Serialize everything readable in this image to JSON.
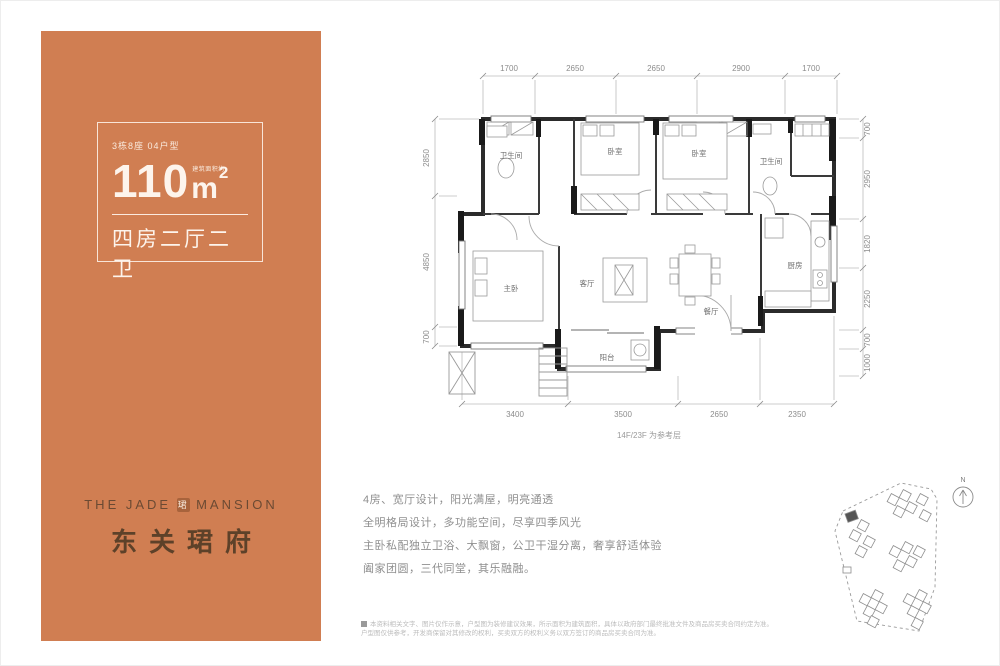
{
  "panel": {
    "unit_label": "3栋8座 04户型",
    "area_prefix": "建筑面积约",
    "area_value": "110",
    "area_unit": "m",
    "area_sup": "2",
    "layout_label": "四房二厅二卫",
    "brand_en_left": "THE JADE",
    "brand_logo_glyph": "珺",
    "brand_en_right": "MANSION",
    "brand_cn": "东关珺府",
    "bg_color": "#d07e52"
  },
  "floorplan": {
    "dims_top": [
      "1700",
      "2650",
      "2650",
      "2900",
      "1700"
    ],
    "dims_bottom": [
      "3400",
      "3500",
      "2650",
      "2350"
    ],
    "dims_left": [
      "2850",
      "4850",
      "700"
    ],
    "dims_right": [
      "700",
      "2950",
      "1820",
      "2250",
      "700",
      "1000"
    ],
    "note": "14F/23F 为参考层",
    "rooms": {
      "bath1": "卫生间",
      "bed1": "卧室",
      "bed2": "卧室",
      "bath2": "卫生间",
      "kitchen": "厨房",
      "living": "客厅",
      "dining": "餐厅",
      "master": "主卧",
      "balcony": "阳台"
    }
  },
  "description": {
    "lines": [
      "4房、宽厅设计，阳光满屋，明亮通透",
      "全明格局设计，多功能空间，尽享四季风光",
      "主卧私配独立卫浴、大飘窗，公卫干湿分离，奢享舒适体验",
      "阖家团圆，三代同堂，其乐融融。"
    ]
  },
  "disclaimer": {
    "lines": [
      "本资料相关文字、图片仅作示意，户型图为装修建议效果，所示面积为建筑面积，具体以政府部门最终批准文件及商品房买卖合同约定为准。",
      "户型图仅供参考，开发商保留对其修改的权利，买卖双方的权利义务以双方签订的商品房买卖合同为准。"
    ]
  },
  "sitemap": {
    "compass_label": "N"
  }
}
